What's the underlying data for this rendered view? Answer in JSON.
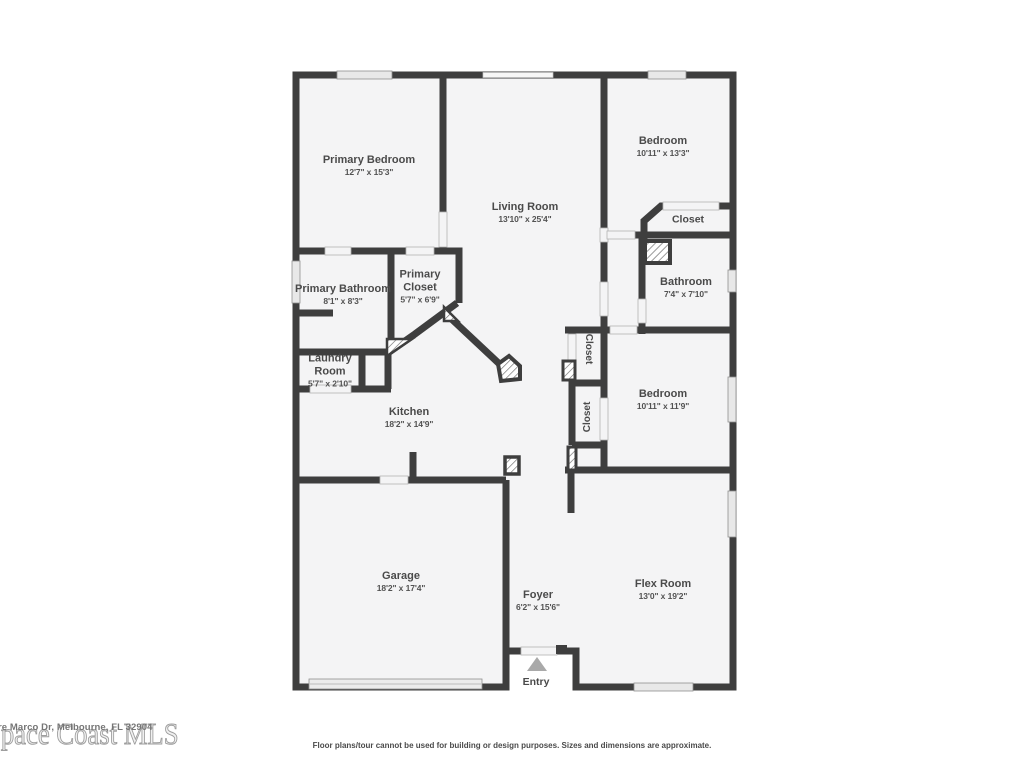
{
  "page": {
    "background": "#ffffff",
    "wall_color": "#3e3e3e",
    "floor_color": "#f4f4f5"
  },
  "plan": {
    "rooms": [
      {
        "id": "primary-bedroom",
        "name": "Primary Bedroom",
        "dims": "12'7\" x 15'3\""
      },
      {
        "id": "living-room",
        "name": "Living Room",
        "dims": "13'10\" x 25'4\""
      },
      {
        "id": "bedroom-top-right",
        "name": "Bedroom",
        "dims": "10'11\" x 13'3\""
      },
      {
        "id": "closet-top-right",
        "name": "Closet",
        "dims": ""
      },
      {
        "id": "bathroom",
        "name": "Bathroom",
        "dims": "7'4\" x 7'10\""
      },
      {
        "id": "primary-bathroom",
        "name": "Primary Bathroom",
        "dims": "8'1\" x 8'3\""
      },
      {
        "id": "primary-closet",
        "name": "Primary Closet",
        "dims": "5'7\" x 6'9\""
      },
      {
        "id": "laundry-room",
        "name": "Laundry Room",
        "dims": "5'7\" x 2'10\""
      },
      {
        "id": "kitchen",
        "name": "Kitchen",
        "dims": "18'2\" x 14'9\""
      },
      {
        "id": "closet-hall-upper",
        "name": "Closet",
        "dims": ""
      },
      {
        "id": "closet-hall-lower",
        "name": "Closet",
        "dims": ""
      },
      {
        "id": "bedroom-right",
        "name": "Bedroom",
        "dims": "10'11\" x 11'9\""
      },
      {
        "id": "garage",
        "name": "Garage",
        "dims": "18'2\" x 17'4\""
      },
      {
        "id": "foyer",
        "name": "Foyer",
        "dims": "6'2\" x 15'6\""
      },
      {
        "id": "flex-room",
        "name": "Flex Room",
        "dims": "13'0\" x 19'2\""
      }
    ],
    "entry_label": "Entry"
  },
  "watermark": {
    "brand": "Space Coast MLS",
    "address": "re Marco Dr, Melbourne, FL 32904"
  },
  "footer": {
    "disclaimer": "Floor plans/tour cannot be used for building or design purposes. Sizes and dimensions are approximate."
  }
}
